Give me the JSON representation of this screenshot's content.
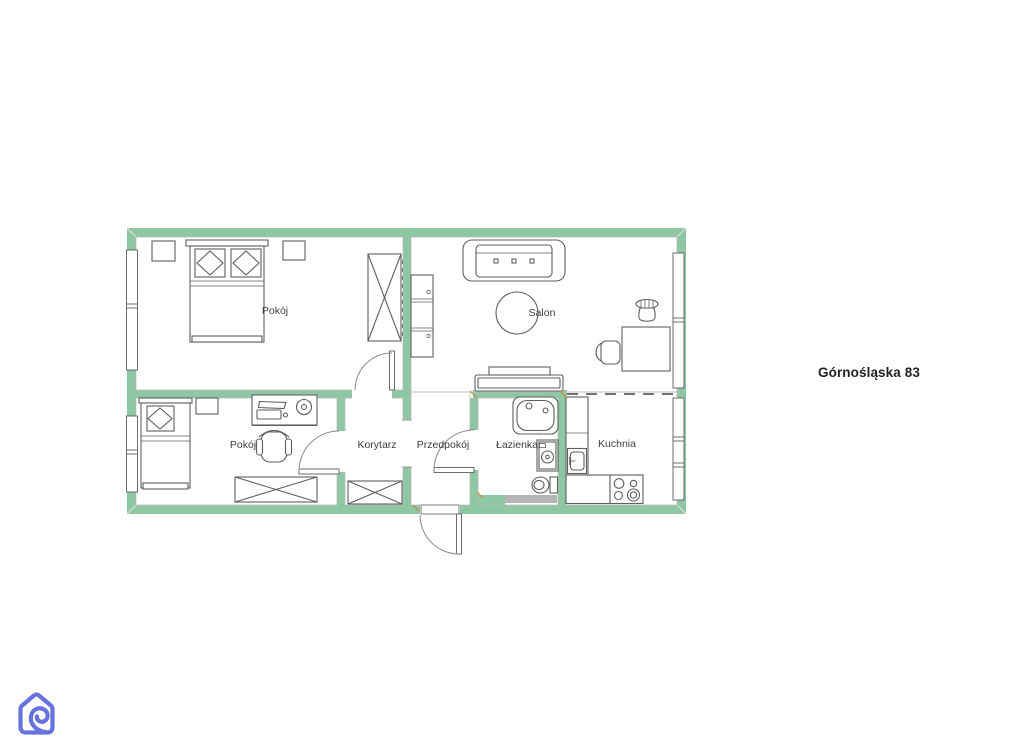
{
  "page": {
    "background": "#ffffff"
  },
  "address_label": "Górnośląska 83",
  "floorplan": {
    "wall_color": "#8ec7a3",
    "line_color": "#5f5f5f",
    "room_label_color": "#3d3d3d",
    "rooms": [
      {
        "id": "pokoj-top",
        "label": "Pokój"
      },
      {
        "id": "salon",
        "label": "Salon"
      },
      {
        "id": "pokoj-bottom",
        "label": "Pokój"
      },
      {
        "id": "korytarz",
        "label": "Korytarz"
      },
      {
        "id": "przedpokoj",
        "label": "Przedpokój"
      },
      {
        "id": "lazienka",
        "label": "Łazienka"
      },
      {
        "id": "kuchnia",
        "label": "Kuchnia"
      }
    ]
  },
  "logo": {
    "name": "house-loop-logo",
    "color": "#6673df"
  }
}
